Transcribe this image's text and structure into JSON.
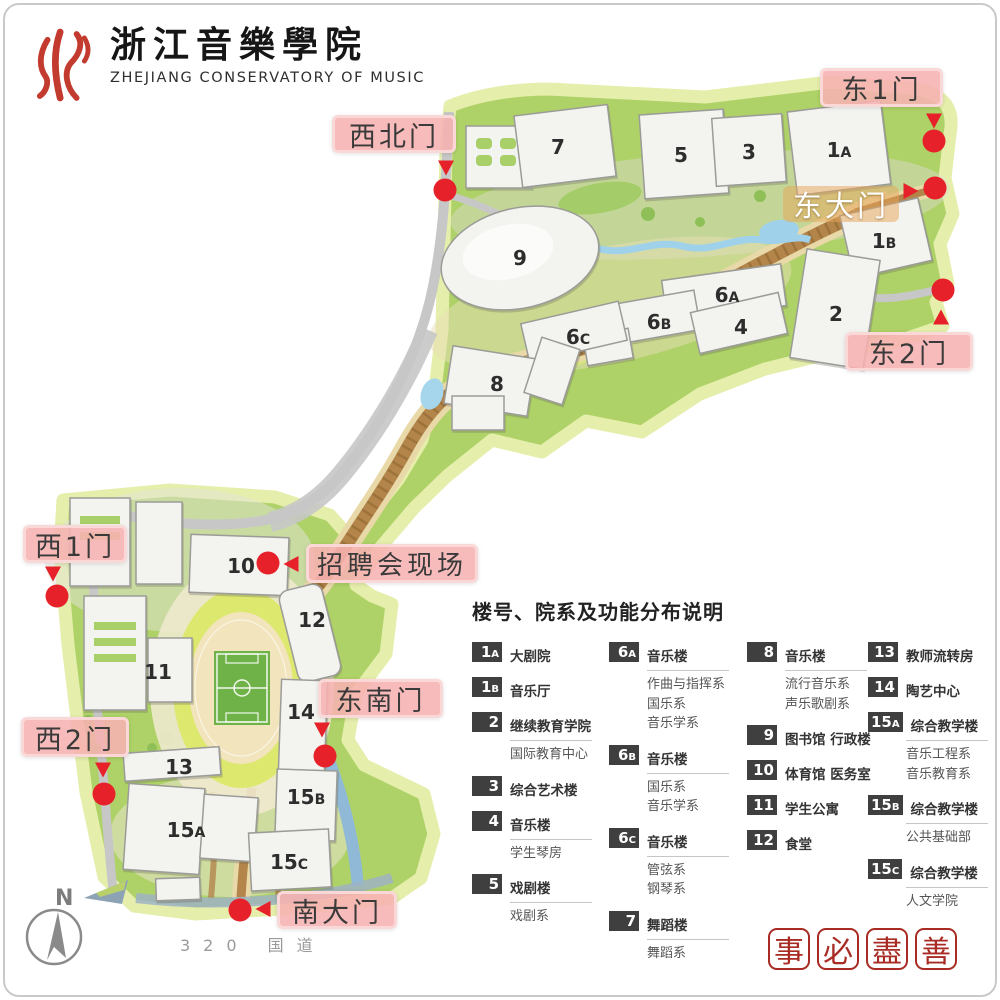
{
  "header": {
    "logo": {
      "cn": "浙江音樂學院",
      "en": "ZHEJIANG CONSERVATORY OF MUSIC"
    }
  },
  "map": {
    "compass_label": "N",
    "road_label": "320 国道",
    "buildings": [
      {
        "id": "7",
        "x": 558,
        "y": 147
      },
      {
        "id": "5",
        "x": 681,
        "y": 155
      },
      {
        "id": "3",
        "x": 749,
        "y": 152
      },
      {
        "id": "1A",
        "x": 839,
        "y": 150
      },
      {
        "id": "1B",
        "x": 884,
        "y": 241
      },
      {
        "id": "9",
        "x": 520,
        "y": 258
      },
      {
        "id": "6A",
        "x": 727,
        "y": 295
      },
      {
        "id": "6B",
        "x": 659,
        "y": 322
      },
      {
        "id": "6C",
        "x": 578,
        "y": 337
      },
      {
        "id": "4",
        "x": 741,
        "y": 327
      },
      {
        "id": "2",
        "x": 836,
        "y": 314
      },
      {
        "id": "8",
        "x": 497,
        "y": 384
      },
      {
        "id": "10",
        "x": 241,
        "y": 566
      },
      {
        "id": "12",
        "x": 312,
        "y": 620
      },
      {
        "id": "11",
        "x": 158,
        "y": 672
      },
      {
        "id": "14",
        "x": 301,
        "y": 712
      },
      {
        "id": "13",
        "x": 179,
        "y": 767
      },
      {
        "id": "15A",
        "x": 186,
        "y": 830
      },
      {
        "id": "15B",
        "x": 306,
        "y": 797
      },
      {
        "id": "15C",
        "x": 289,
        "y": 862
      }
    ],
    "gates": [
      {
        "id": "east-1",
        "label": "东1门",
        "x": 820,
        "y": 68,
        "w": 123,
        "h": 39,
        "style": "pink"
      },
      {
        "id": "northwest",
        "label": "西北门",
        "x": 332,
        "y": 115,
        "w": 124,
        "h": 38,
        "style": "pink"
      },
      {
        "id": "east-main",
        "label": "东大门",
        "x": 783,
        "y": 186,
        "w": 116,
        "h": 36,
        "style": "orange"
      },
      {
        "id": "east-2",
        "label": "东2门",
        "x": 845,
        "y": 332,
        "w": 128,
        "h": 39,
        "style": "pink"
      },
      {
        "id": "west-1",
        "label": "西1门",
        "x": 23,
        "y": 525,
        "w": 104,
        "h": 38,
        "style": "pink"
      },
      {
        "id": "job-fair",
        "label": "招聘会现场",
        "x": 306,
        "y": 544,
        "w": 172,
        "h": 39,
        "style": "pink wide"
      },
      {
        "id": "southeast",
        "label": "东南门",
        "x": 318,
        "y": 679,
        "w": 125,
        "h": 39,
        "style": "pink"
      },
      {
        "id": "west-2",
        "label": "西2门",
        "x": 21,
        "y": 717,
        "w": 108,
        "h": 40,
        "style": "pink"
      },
      {
        "id": "south-main",
        "label": "南大门",
        "x": 277,
        "y": 891,
        "w": 120,
        "h": 38,
        "style": "pink"
      }
    ],
    "markers": [
      {
        "id": "northwest",
        "cx": 445,
        "cy": 190,
        "arrow": {
          "x": 446,
          "y": 168,
          "dir": "down"
        }
      },
      {
        "id": "east-1",
        "cx": 934,
        "cy": 141,
        "arrow": {
          "x": 934,
          "y": 121,
          "dir": "down"
        }
      },
      {
        "id": "east-main",
        "cx": 935,
        "cy": 188,
        "arrow": {
          "x": 911,
          "y": 191,
          "dir": "right"
        }
      },
      {
        "id": "east-2",
        "cx": 943,
        "cy": 290,
        "arrow": {
          "x": 941,
          "y": 317,
          "dir": "up"
        }
      },
      {
        "id": "west-1",
        "cx": 57,
        "cy": 596,
        "arrow": {
          "x": 53,
          "y": 574,
          "dir": "down"
        }
      },
      {
        "id": "job-fair",
        "cx": 268,
        "cy": 563,
        "arrow": {
          "x": 291,
          "y": 564,
          "dir": "left"
        }
      },
      {
        "id": "southeast",
        "cx": 325,
        "cy": 756,
        "arrow": {
          "x": 322,
          "y": 730,
          "dir": "down"
        }
      },
      {
        "id": "west-2",
        "cx": 104,
        "cy": 794,
        "arrow": {
          "x": 103,
          "y": 770,
          "dir": "down"
        }
      },
      {
        "id": "south-main",
        "cx": 240,
        "cy": 910,
        "arrow": {
          "x": 263,
          "y": 909,
          "dir": "left"
        }
      }
    ]
  },
  "legend": {
    "title": "楼号、院系及功能分布说明",
    "columns": [
      [
        {
          "id": "1A",
          "title": "大剧院",
          "subs": []
        },
        {
          "id": "1B",
          "title": "音乐厅",
          "subs": []
        },
        {
          "id": "2",
          "title": "继续教育学院",
          "subs": [
            "国际教育中心"
          ]
        },
        {
          "id": "3",
          "title": "综合艺术楼",
          "subs": []
        },
        {
          "id": "4",
          "title": "音乐楼",
          "subs": [
            "学生琴房"
          ]
        },
        {
          "id": "5",
          "title": "戏剧楼",
          "subs": [
            "戏剧系"
          ]
        }
      ],
      [
        {
          "id": "6A",
          "title": "音乐楼",
          "subs": [
            "作曲与指挥系",
            "国乐系",
            "音乐学系"
          ]
        },
        {
          "id": "6B",
          "title": "音乐楼",
          "subs": [
            "国乐系",
            "音乐学系"
          ]
        },
        {
          "id": "6C",
          "title": "音乐楼",
          "subs": [
            "管弦系",
            "钢琴系"
          ]
        },
        {
          "id": "7",
          "title": "舞蹈楼",
          "subs": [
            "舞蹈系"
          ]
        }
      ],
      [
        {
          "id": "8",
          "title": "音乐楼",
          "subs": [
            "流行音乐系",
            "声乐歌剧系"
          ]
        },
        {
          "id": "9",
          "title": "图书馆 行政楼",
          "subs": []
        },
        {
          "id": "10",
          "title": "体育馆 医务室",
          "subs": []
        },
        {
          "id": "11",
          "title": "学生公寓",
          "subs": []
        },
        {
          "id": "12",
          "title": "食堂",
          "subs": []
        }
      ],
      [
        {
          "id": "13",
          "title": "教师流转房",
          "subs": []
        },
        {
          "id": "14",
          "title": "陶艺中心",
          "subs": []
        },
        {
          "id": "15A",
          "title": "综合教学楼",
          "subs": [
            "音乐工程系",
            "音乐教育系"
          ]
        },
        {
          "id": "15B",
          "title": "综合教学楼",
          "subs": [
            "公共基础部"
          ]
        },
        {
          "id": "15C",
          "title": "综合教学楼",
          "subs": [
            "人文学院"
          ]
        }
      ]
    ]
  },
  "seal": {
    "chars": [
      "事",
      "必",
      "盡",
      "善"
    ]
  }
}
